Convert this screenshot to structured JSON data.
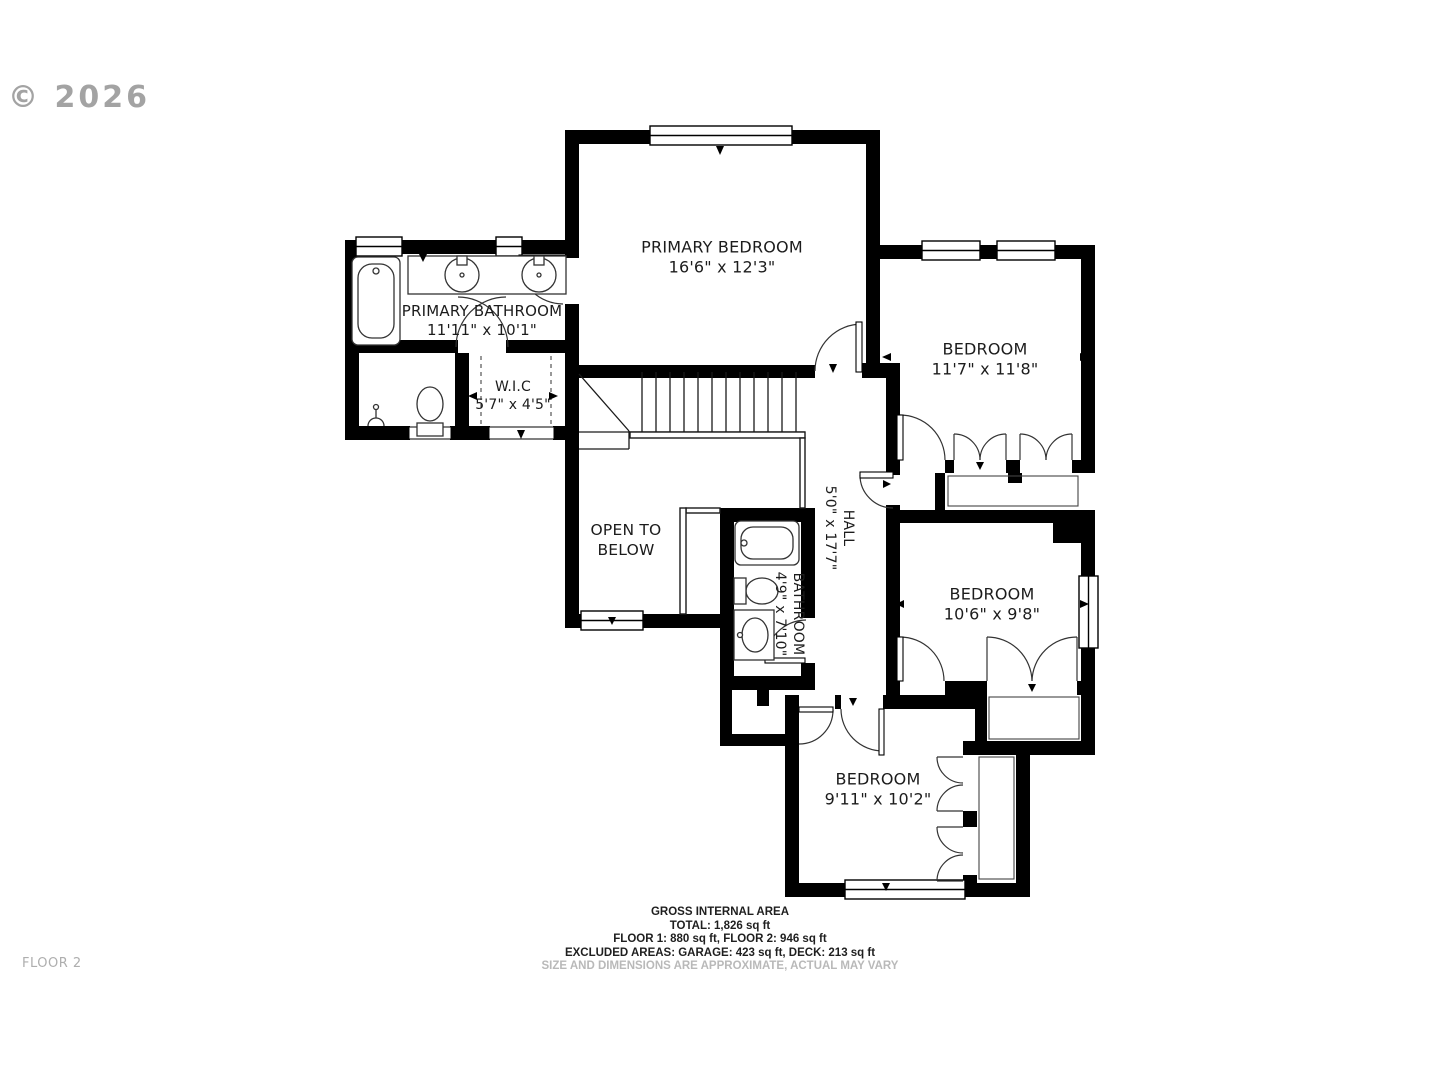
{
  "meta": {
    "copyright": "© 2026",
    "floor_label": "FLOOR 2"
  },
  "rooms": {
    "primary_bedroom": {
      "name": "PRIMARY BEDROOM",
      "dims": "16'6\" x 12'3\""
    },
    "primary_bathroom": {
      "name": "PRIMARY BATHROOM",
      "dims": "11'11\" x 10'1\""
    },
    "wic": {
      "name": "W.I.C",
      "dims": "5'7\" x 4'5\""
    },
    "bedroom_top_right": {
      "name": "BEDROOM",
      "dims": "11'7\" x 11'8\""
    },
    "bedroom_mid_right": {
      "name": "BEDROOM",
      "dims": "10'6\" x 9'8\""
    },
    "bedroom_bottom": {
      "name": "BEDROOM",
      "dims": "9'11\" x 10'2\""
    },
    "hall": {
      "name": "HALL",
      "dims": "5'0\" x 17'7\""
    },
    "bathroom": {
      "name": "BATHROOM",
      "dims": "4'9\" x 7'10\""
    },
    "open_to_below": {
      "name": "OPEN TO BELOW"
    }
  },
  "footer": {
    "line1": "GROSS INTERNAL AREA",
    "line2": "TOTAL: 1,826 sq ft",
    "line3": "FLOOR 1: 880 sq ft, FLOOR 2: 946 sq ft",
    "line4": "EXCLUDED AREAS: GARAGE: 423 sq ft, DECK: 213 sq ft",
    "disclaimer": "SIZE AND DIMENSIONS ARE APPROXIMATE, ACTUAL MAY VARY"
  },
  "colors": {
    "wall": "#000000",
    "line": "#1a1a1a",
    "muted": "#b9b9b9",
    "copyright": "#9a9a9a"
  }
}
